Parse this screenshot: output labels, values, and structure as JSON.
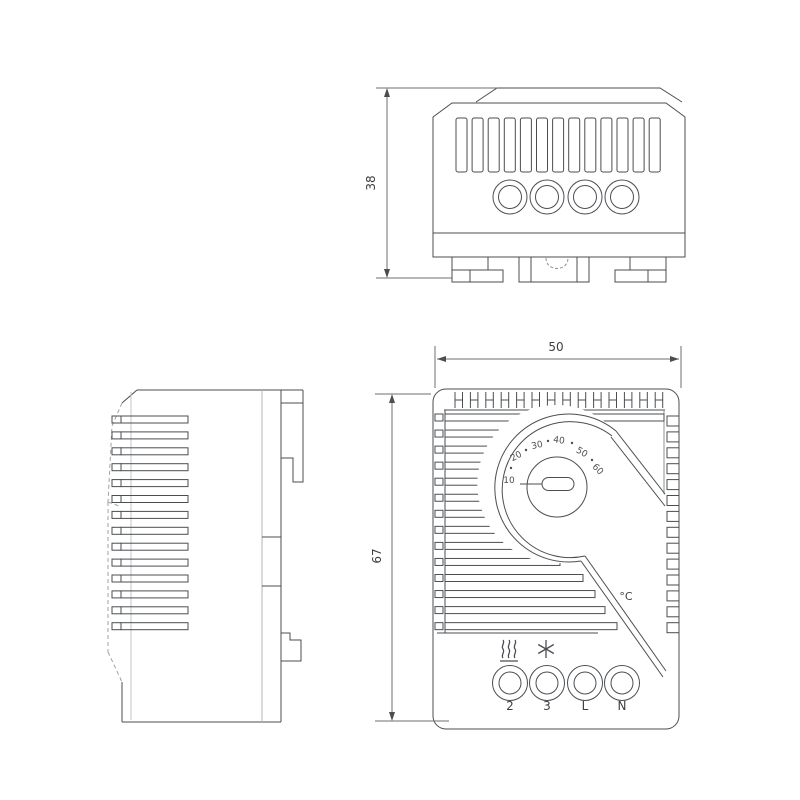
{
  "dimensions": {
    "depth_label": "38",
    "width_label": "50",
    "height_label": "67"
  },
  "dial": {
    "scale_labels": [
      "10",
      "20",
      "30",
      "40",
      "50",
      "60"
    ],
    "unit_label": "°C"
  },
  "terminals": {
    "labels": [
      "2",
      "3",
      "L",
      "N"
    ]
  },
  "icons": {
    "heating": "heating-element-icon",
    "cooling": "snowflake-icon"
  },
  "counts": {
    "top_view_vent_slots": 13,
    "top_view_terminals": 4,
    "side_view_vent_slats": 14,
    "front_view_top_slots": 14,
    "front_view_left_slats": 14,
    "front_view_right_slots": 14,
    "front_view_terminals": 4
  },
  "style": {
    "line_color": "#4a4e52",
    "light_line_color": "#b3b6b9",
    "background": "#ffffff"
  }
}
